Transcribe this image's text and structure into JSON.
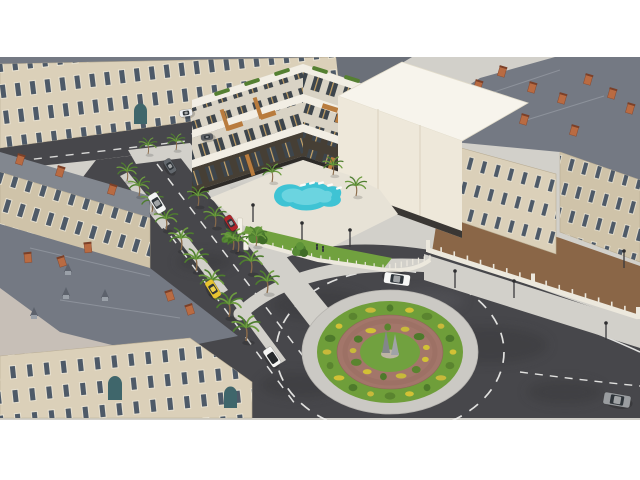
{
  "meta": {
    "description": "Aerial 3D architectural rendering of a modern white apartment complex with rooftop terraces and a curved swimming pool, set among classic Haussmann-style stone buildings with slate mansard roofs, around a landscaped traffic roundabout with a central monument, palm-lined streets and cars.",
    "canvas": {
      "width": 640,
      "height": 480
    },
    "letterbox": {
      "top": 57,
      "bottom": 420
    }
  },
  "palette": {
    "asphalt": "#47474b",
    "sidewalk": "#d2d0ca",
    "cobble": "#c7bfb7",
    "curb": "#e3e0da",
    "facade": "#dbd0b9",
    "facade2": "#cfc3a9",
    "roof": "#747983",
    "roof2": "#82878f",
    "chimney": "#b96b42",
    "window": "#4e5a68",
    "frame": "#eee7d6",
    "modern": "#f2eee4",
    "modern2": "#d9d3c5",
    "wood": "#b97c3e",
    "glazing": "#3d454c",
    "storefront": "#463f35",
    "hedge": "#558032",
    "lawn": "#71a13f",
    "grass": "#6f9e3a",
    "bushY": "#d2c135",
    "bushG": "#52802d",
    "brick": "#a3766a",
    "pool": "#3fc3d4",
    "pool2": "#8fe2ea",
    "fenceW": "#ece8dd",
    "door": "#3f666b",
    "dirt": "#8a6647",
    "mark": "#f2f2f0",
    "trunk": "#8a6b4a",
    "frond": "#4e7d2f",
    "frond2": "#6d9c3f"
  },
  "scene": {
    "roundabout": {
      "cx": 390,
      "cy": 352,
      "apron": [
        88,
        62
      ],
      "grass": [
        73,
        51
      ],
      "brickRing": [
        53,
        37
      ],
      "innerGrass": [
        30,
        20
      ],
      "bushRings": [
        {
          "count": 20,
          "rx": 63,
          "ry": 44
        },
        {
          "count": 13,
          "rx": 37,
          "ry": 25
        }
      ],
      "bushColors": [
        "#d2c135",
        "#5a842f",
        "#c8b93a",
        "#4e7a2b"
      ],
      "monument": "twin-obelisk-sculpture"
    },
    "cars": [
      {
        "name": "white-van-parked",
        "x": 157,
        "y": 203,
        "a": 58,
        "l": 21,
        "w": 10,
        "c": "#f3f4f4",
        "t": "van"
      },
      {
        "name": "gray-car",
        "x": 170,
        "y": 166,
        "a": 58,
        "l": 15,
        "w": 8,
        "c": "#62676d",
        "t": "car"
      },
      {
        "name": "red-car",
        "x": 231,
        "y": 223,
        "a": 58,
        "l": 16,
        "w": 8,
        "c": "#b3252b",
        "t": "car"
      },
      {
        "name": "yellow-taxi",
        "x": 213,
        "y": 289,
        "a": 58,
        "l": 19,
        "w": 9,
        "c": "#e7c430",
        "t": "car"
      },
      {
        "name": "white-convertible",
        "x": 272,
        "y": 357,
        "a": 56,
        "l": 20,
        "w": 10,
        "c": "#f5f5f3",
        "t": "open"
      },
      {
        "name": "white-sedan-roundabout",
        "x": 397,
        "y": 279,
        "a": 188,
        "l": 26,
        "w": 11,
        "c": "#f8f8f6",
        "t": "car"
      },
      {
        "name": "silver-suv",
        "x": 617,
        "y": 400,
        "a": 10,
        "l": 27,
        "w": 12,
        "c": "#9a9da0",
        "t": "car"
      },
      {
        "name": "white-van-top",
        "x": 186,
        "y": 113,
        "a": -8,
        "l": 13,
        "w": 7,
        "c": "#eef0f2",
        "t": "van"
      },
      {
        "name": "dark-car-top",
        "x": 207,
        "y": 137,
        "a": -8,
        "l": 12,
        "w": 6,
        "c": "#5a5e63",
        "t": "car"
      }
    ],
    "palms": [
      [
        127,
        181,
        0.9
      ],
      [
        139,
        196,
        0.95
      ],
      [
        152,
        212,
        1.0
      ],
      [
        166,
        230,
        1.05
      ],
      [
        181,
        250,
        1.1
      ],
      [
        196,
        271,
        1.1
      ],
      [
        212,
        293,
        1.15
      ],
      [
        229,
        317,
        1.2
      ],
      [
        246,
        341,
        1.25
      ],
      [
        198,
        206,
        0.95
      ],
      [
        215,
        227,
        1.0
      ],
      [
        233,
        250,
        1.05
      ],
      [
        251,
        273,
        1.1
      ],
      [
        267,
        293,
        1.1
      ],
      [
        148,
        154,
        0.8
      ],
      [
        176,
        150,
        0.8
      ],
      [
        272,
        182,
        0.9
      ],
      [
        333,
        175,
        0.9
      ],
      [
        356,
        196,
        0.95
      ],
      [
        238,
        252,
        1.0
      ],
      [
        256,
        246,
        0.95
      ]
    ],
    "trees": [
      [
        258,
        236,
        1.2
      ],
      [
        300,
        250,
        1.0
      ],
      [
        228,
        238,
        0.8
      ]
    ],
    "lamps": [
      [
        253,
        222
      ],
      [
        302,
        240
      ],
      [
        350,
        247
      ],
      [
        455,
        288
      ],
      [
        514,
        298
      ],
      [
        606,
        340
      ],
      [
        624,
        268
      ]
    ],
    "pedestrians": [
      [
        317,
        250
      ],
      [
        323,
        252
      ]
    ],
    "chimneys": [
      [
        20,
        160,
        17
      ],
      [
        60,
        172,
        17
      ],
      [
        112,
        190,
        17
      ],
      [
        170,
        296,
        -18
      ],
      [
        190,
        310,
        -18
      ],
      [
        62,
        262,
        -18
      ],
      [
        28,
        258,
        -6
      ],
      [
        88,
        248,
        -6
      ],
      [
        455,
        100,
        16
      ],
      [
        478,
        86,
        16
      ],
      [
        502,
        72,
        16
      ],
      [
        532,
        88,
        16
      ],
      [
        562,
        99,
        16
      ],
      [
        588,
        80,
        16
      ],
      [
        612,
        94,
        16
      ],
      [
        630,
        109,
        16
      ],
      [
        524,
        120,
        16
      ],
      [
        574,
        131,
        16
      ]
    ],
    "dormers": [
      [
        105,
        298
      ],
      [
        68,
        272
      ],
      [
        34,
        316
      ],
      [
        66,
        296
      ]
    ],
    "roofHedges": [
      [
        222,
        92,
        -18
      ],
      [
        252,
        82,
        -18
      ],
      [
        282,
        72,
        -18
      ],
      [
        320,
        70,
        17
      ],
      [
        352,
        79,
        17
      ],
      [
        384,
        88,
        17
      ],
      [
        410,
        96,
        17
      ]
    ],
    "awnings": [
      [
        235,
        126,
        -18
      ],
      [
        268,
        115,
        -18
      ],
      [
        330,
        108,
        17
      ],
      [
        368,
        119,
        17
      ],
      [
        400,
        128,
        17
      ]
    ],
    "woodPillars": [
      [
        225,
        120,
        -18
      ],
      [
        258,
        108,
        -18
      ],
      [
        340,
        112,
        17
      ],
      [
        378,
        124,
        17
      ],
      [
        250,
        165,
        -18
      ],
      [
        330,
        168,
        17
      ],
      [
        365,
        178,
        17
      ]
    ],
    "parkingTicks": [
      [
        196,
        133
      ],
      [
        210,
        131
      ],
      [
        224,
        129
      ],
      [
        238,
        127
      ],
      [
        252,
        126
      ]
    ],
    "loungers": [
      [
        303,
        185
      ],
      [
        312,
        183
      ],
      [
        321,
        183
      ],
      [
        330,
        185
      ],
      [
        339,
        188
      ]
    ],
    "balustrade": {
      "x1": 428,
      "y1": 250,
      "x2": 638,
      "y2": 317,
      "posts": 16
    },
    "gardenFence": {
      "pts": [
        [
          244,
          240
        ],
        [
          318,
          260
        ],
        [
          386,
          270
        ],
        [
          430,
          260
        ]
      ],
      "slats": 24
    },
    "gatePillars": [
      [
        240,
        232
      ],
      [
        246,
        248
      ]
    ]
  }
}
